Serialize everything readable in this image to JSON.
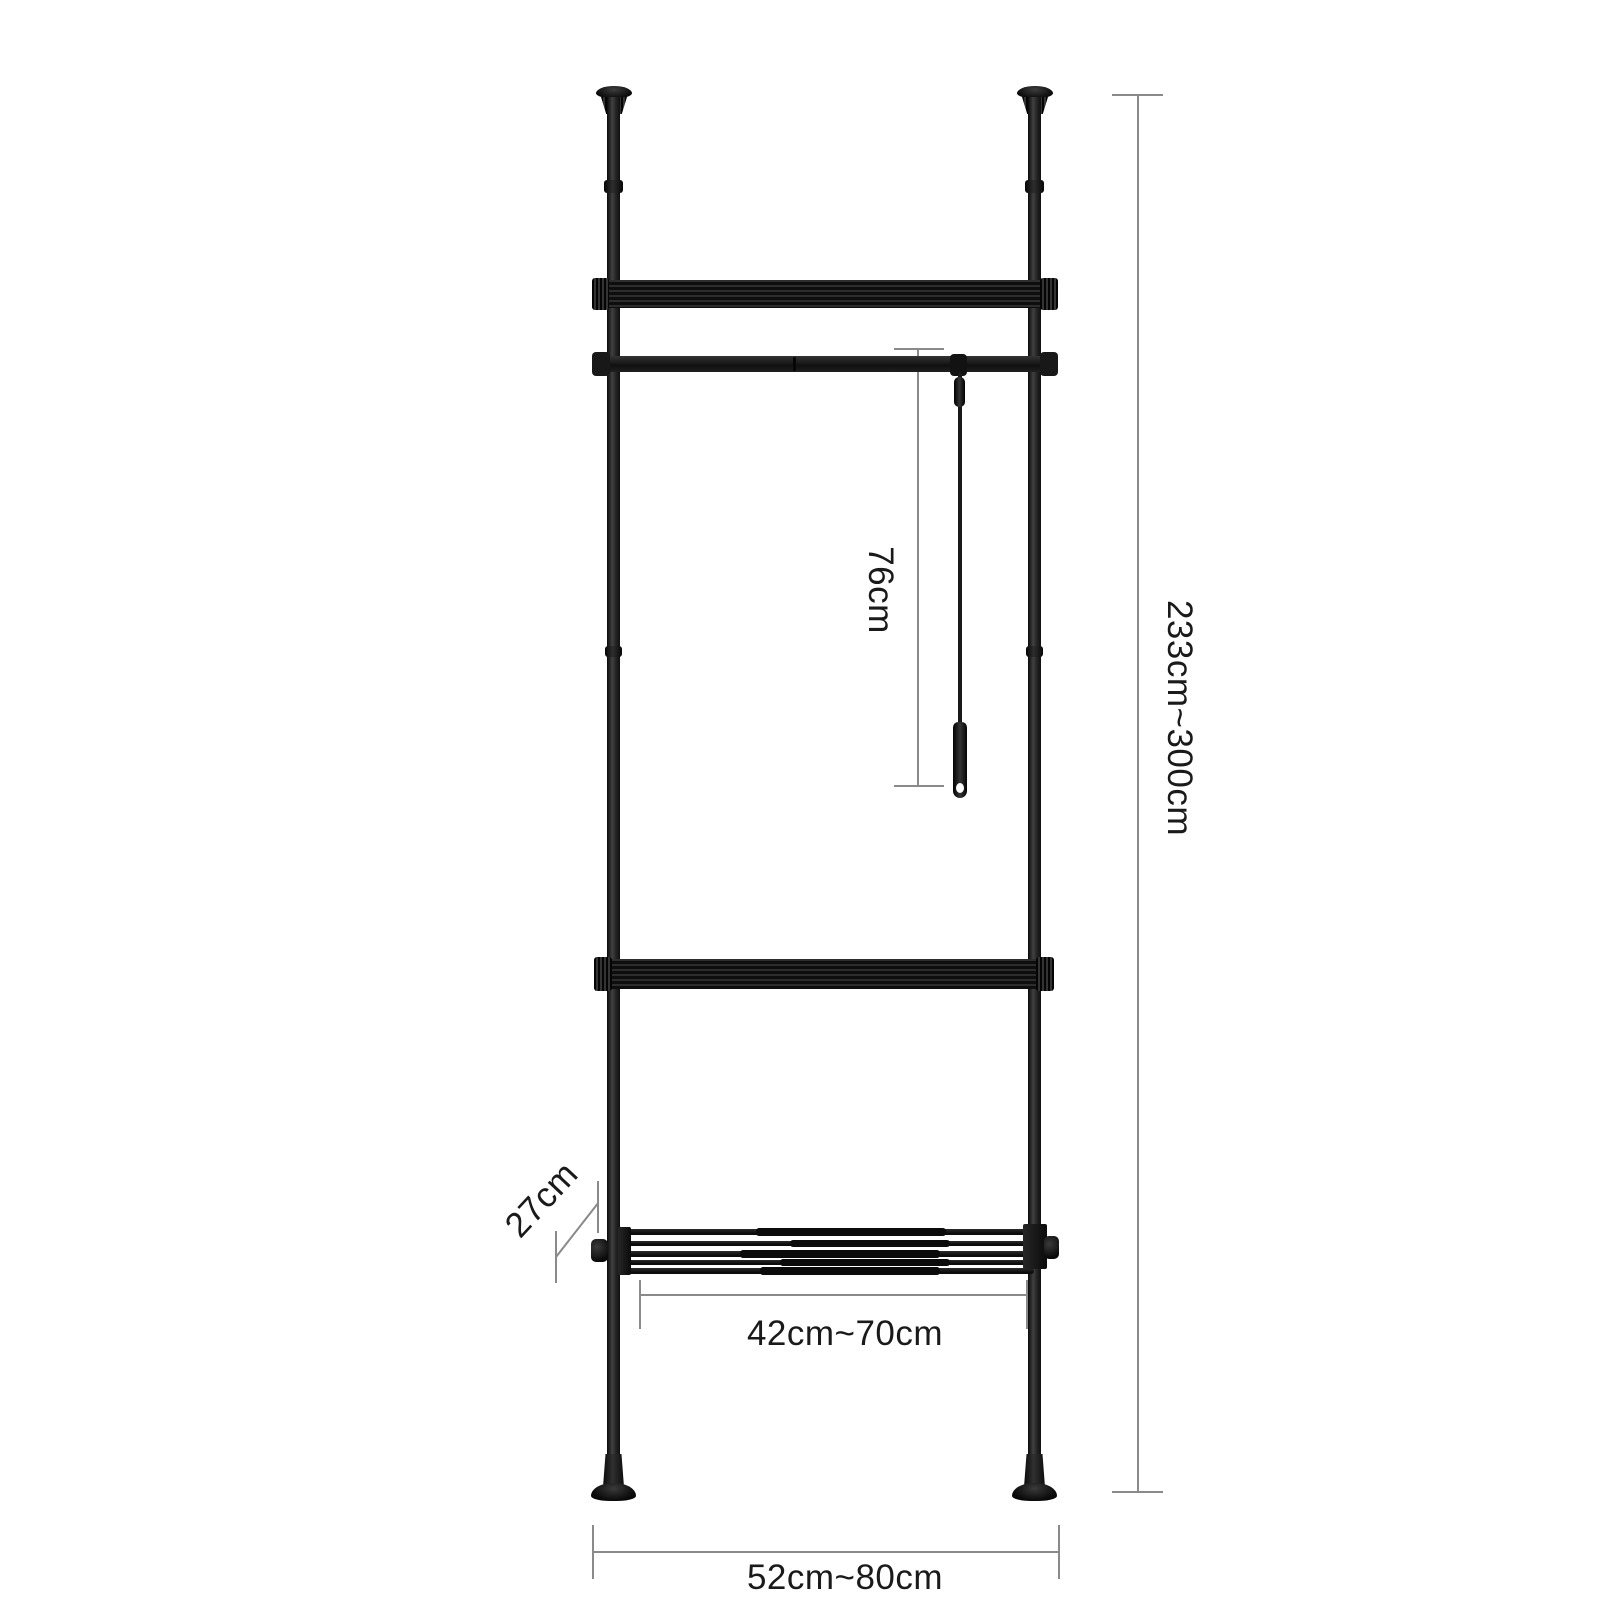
{
  "canvas": {
    "width": 1600,
    "height": 1600,
    "background": "#ffffff"
  },
  "colors": {
    "frame": "#1b1b1b",
    "frame_dark": "#0d0d0d",
    "frame_light": "#383838",
    "dimension_line": "#8a8a8a",
    "label_text": "#1a1a1a"
  },
  "labels": {
    "rod_drop_height": "76cm",
    "overall_height": "233cm~300cm",
    "shelf_depth": "27cm",
    "shelf_width": "42cm~70cm",
    "overall_width": "52cm~80cm"
  }
}
